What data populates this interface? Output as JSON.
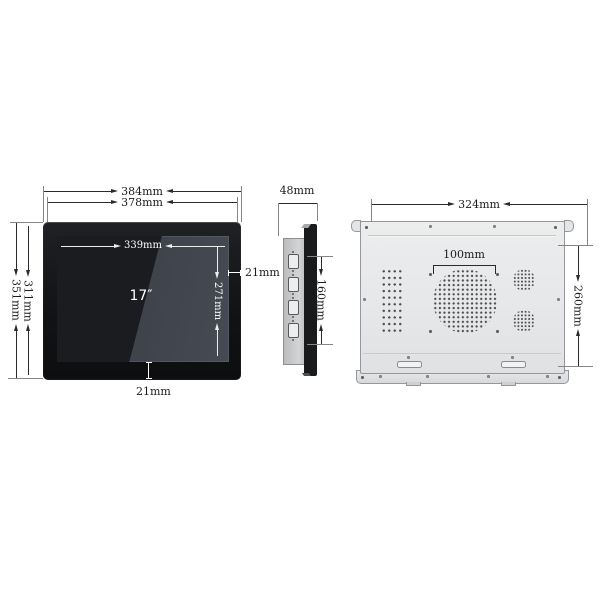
{
  "front_view": {
    "outer_width": "384mm",
    "frame_width": "378mm",
    "outer_height": "351mm",
    "frame_height": "311mm",
    "display_width": "339mm",
    "display_height": "271mm",
    "bezel_right": "21mm",
    "bezel_bottom": "21mm",
    "screen_size": "17″"
  },
  "side_view": {
    "depth": "48mm",
    "port_section_height": "160mm"
  },
  "rear_view": {
    "body_width": "324mm",
    "body_height": "260mm",
    "vesa_spacing": "100mm"
  },
  "icons": {
    "vga_port": "rounded-rect with screw dots",
    "screw": "small gray dot",
    "vent_holes": "dot grid",
    "speaker_grille": "circular dot grid",
    "mounting_slot": "rounded slot"
  },
  "colors": {
    "dimension_line": "#2b2b2b",
    "screen_dimension_line": "#ffffff",
    "bezel_black": "#141518",
    "chassis_gray": "#c9cacc",
    "rear_panel_gray": "#e9eaec",
    "background": "#ffffff"
  }
}
